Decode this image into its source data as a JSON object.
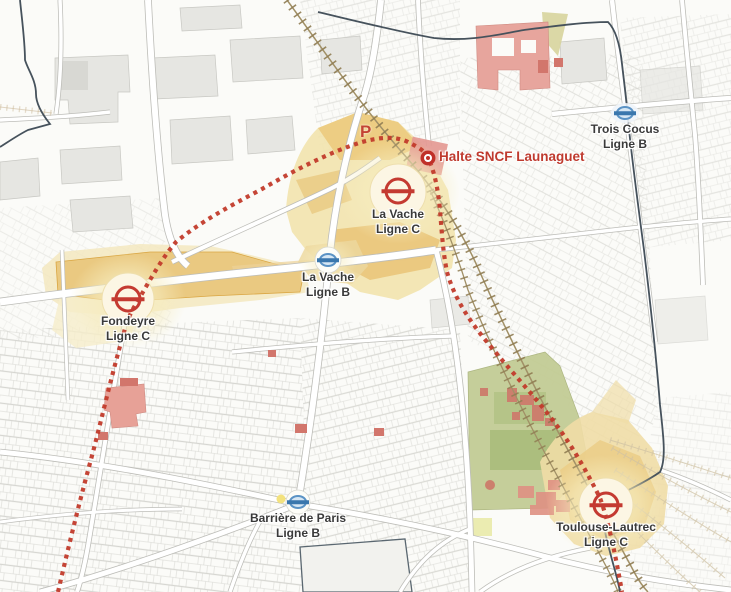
{
  "map": {
    "parking_label": "P",
    "halte": {
      "label": "Halte SNCF Launaguet"
    },
    "stations": [
      {
        "id": "trois-cocus",
        "name": "Trois Cocus",
        "line": "Ligne B",
        "network": "B"
      },
      {
        "id": "la-vache-c",
        "name": "La Vache",
        "line": "Ligne C",
        "network": "C"
      },
      {
        "id": "la-vache-b",
        "name": "La Vache",
        "line": "Ligne B",
        "network": "B"
      },
      {
        "id": "fondeyre",
        "name": "Fondeyre",
        "line": "Ligne C",
        "network": "C"
      },
      {
        "id": "barriere-de-paris",
        "name": "Barrière de Paris",
        "line": "Ligne B",
        "network": "B"
      },
      {
        "id": "toulouse-lautrec",
        "name": "Toulouse-Lautrec",
        "line": "Ligne C",
        "network": "C"
      }
    ],
    "colors": {
      "ligne_c_red": "#c43a31",
      "ligne_b_blue": "#5b93c5",
      "route_dotted_red": "#c23b2b",
      "project_zone_tan": "#eac87e",
      "project_zone_cream": "#f2e3ad",
      "railway_brown": "#8f7c52",
      "green_space": "#c3cc95",
      "pink_building": "#e7a59d",
      "boundary_slate": "#46525c"
    }
  }
}
